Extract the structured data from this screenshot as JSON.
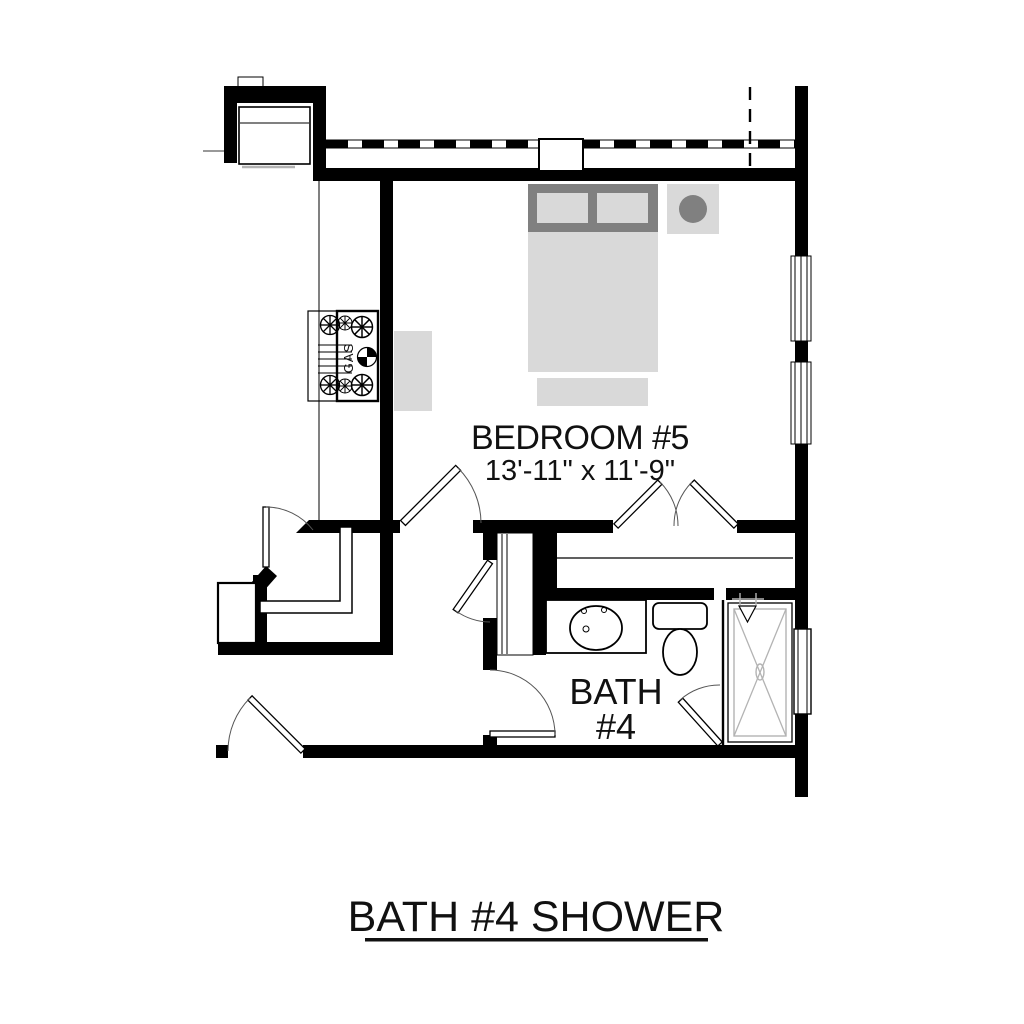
{
  "plan_title": "BATH #4 SHOWER",
  "rooms": {
    "bedroom": {
      "name": "BEDROOM #5",
      "dimensions": "13'-11\" x 11'-9\""
    },
    "bath": {
      "line1": "BATH",
      "line2": "#4"
    }
  },
  "fixtures": {
    "range_label": "GAS",
    "items": [
      "bed",
      "nightstand-lamp",
      "dresser",
      "gas-range",
      "vanity-sink",
      "toilet",
      "shower",
      "fireplace"
    ]
  },
  "colors": {
    "wall": "#000000",
    "furniture_light": "#d9d9d9",
    "furniture_dark": "#808080",
    "shower_lines": "#b3b3b3",
    "text": "#111111"
  }
}
